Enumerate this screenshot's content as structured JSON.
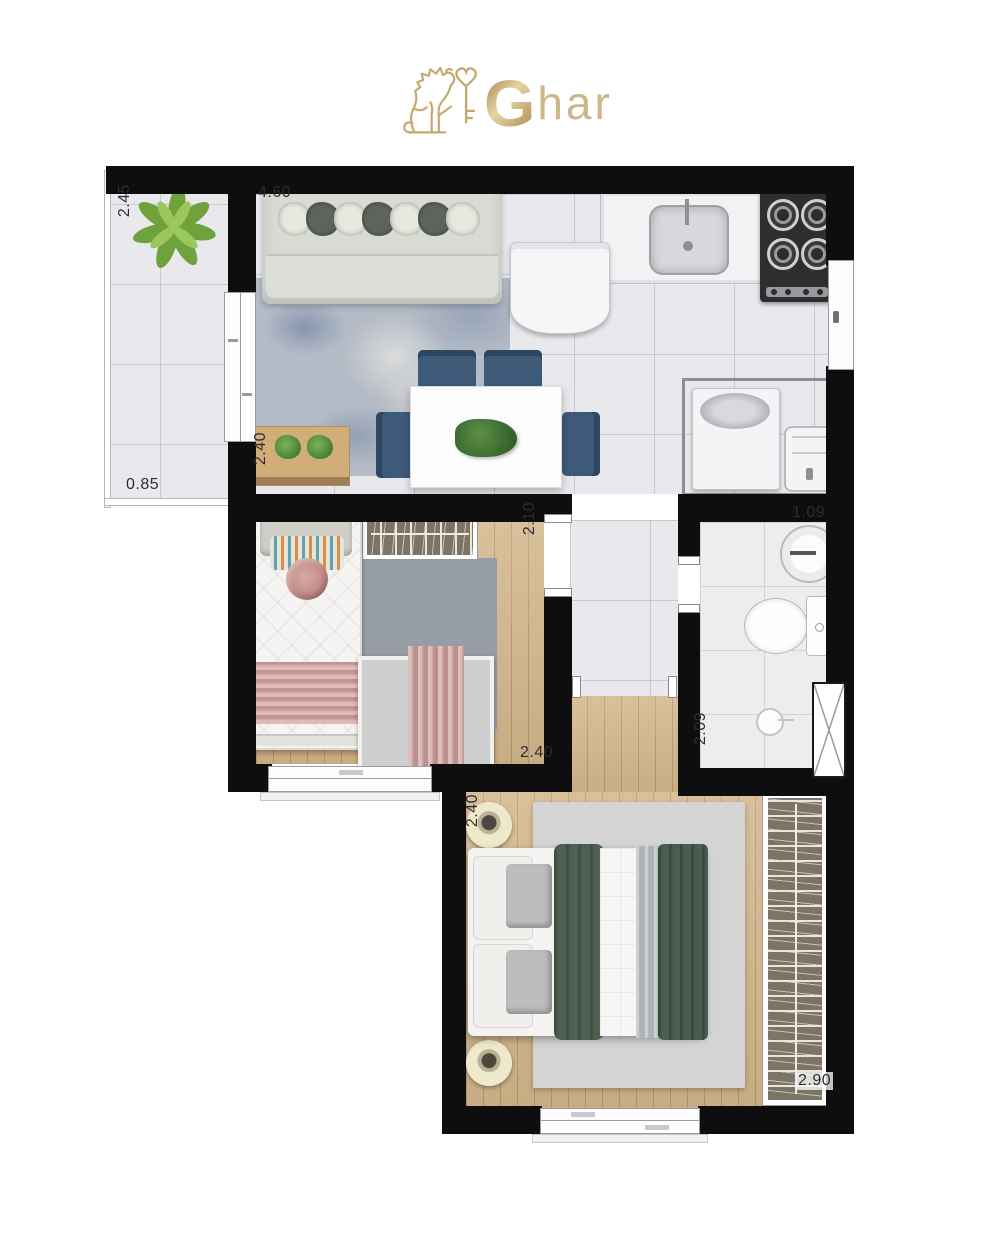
{
  "logo": {
    "g": "G",
    "rest": "har"
  },
  "dimensions": {
    "balcony_width": "2.45",
    "balcony_depth": "0.85",
    "living_width": "4.60",
    "living_depth": "2.40",
    "bedroom1_door_side": "2.10",
    "bedroom1_width": "2.40",
    "bathroom_width": "1.09",
    "bathroom_depth": "2.09",
    "master_depth": "2.40",
    "master_width": "2.90"
  },
  "colors": {
    "wall": "#0e0e0e",
    "brand_gold": "#c2a168",
    "tile_floor": "#e9e9ed",
    "wood_floor": "#d2b68b",
    "dining_chair_blue": "#3d5a78",
    "duvet_green": "#4d6052",
    "blanket_pink": "#d2a6a2",
    "wardrobe_olive": "#7c7567"
  }
}
